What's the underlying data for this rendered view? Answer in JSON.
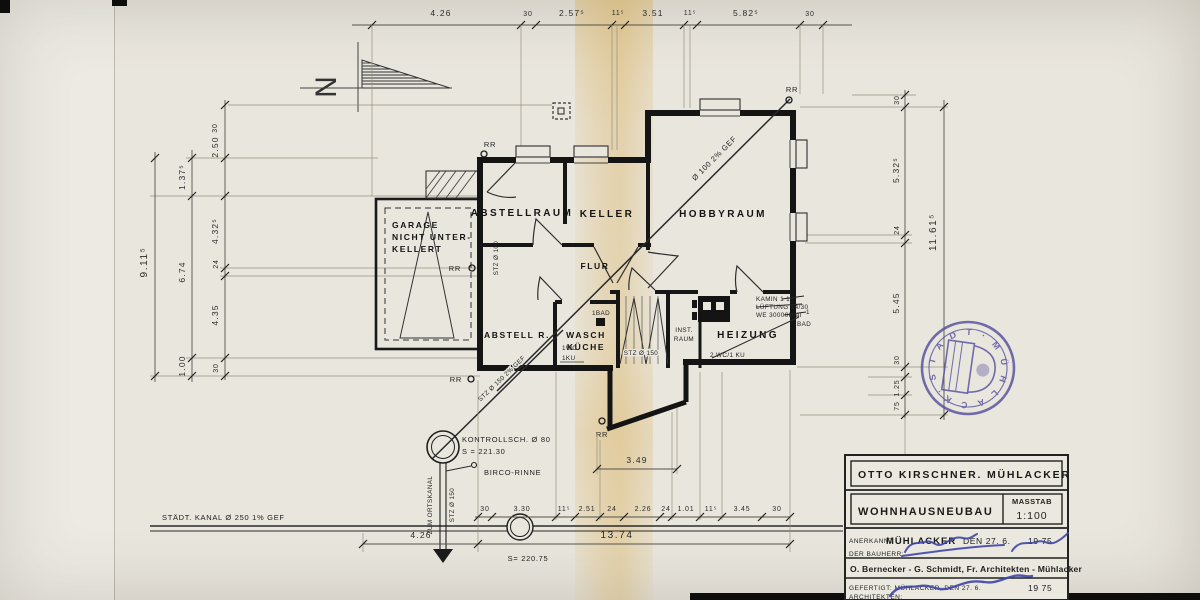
{
  "north": {
    "label": "N"
  },
  "dims": {
    "top": [
      "4.26",
      "30",
      "2.57⁵",
      "11⁵",
      "3.51",
      "11⁵",
      "5.82⁵",
      "30"
    ],
    "left_outer": "9.11⁵",
    "left_middle": [
      "1.37⁵",
      "6.74",
      "1.00"
    ],
    "left_inner": [
      "30",
      "2.50",
      "4.32⁵",
      "24",
      "4.35",
      "30"
    ],
    "right_outer": "11.61⁵",
    "right_inner": [
      "30",
      "5.32⁵",
      "24",
      "5.45",
      "30",
      "1.25",
      "75"
    ],
    "bottom_detail": [
      "30",
      "3.30",
      "11⁵",
      "2.51",
      "24",
      "2.26",
      "24",
      "1.01",
      "11⁵",
      "3.45",
      "30"
    ],
    "bottom_total": "13.74",
    "bottom_left_seg": "4.26",
    "exit_width": "3.49"
  },
  "rooms": {
    "garage_l1": "GARAGE",
    "garage_l2": "NICHT UNTER-",
    "garage_l3": "KELLERT",
    "abstellraum": "ABSTELLRAUM",
    "keller": "KELLER",
    "hobbyraum": "HOBBYRAUM",
    "flur": "FLUR",
    "abstell_r": "ABSTELL R.",
    "wasch_l1": "WASCH",
    "wasch_l2": "KÜCHE",
    "inst_l1": "INST.",
    "inst_l2": "RAUM",
    "heizung": "HEIZUNG"
  },
  "plumbing": {
    "pipe_main": "Ø 100 2% GEF",
    "pipe_stz": "STZ Ø 150 2% GEF",
    "stz100": "STZ Ø 100",
    "stz150_stairs": "STZ Ø 150",
    "rr": "RR",
    "kanal": "STÄDT. KANAL  Ø 250   1% GEF",
    "kontroll_l1": "KONTROLLSCH. Ø 80",
    "kontroll_l2": "S = 221.30",
    "birco": "BIRCO-RINNE",
    "zum_ortskanal": "ZUM ORTSKANAL",
    "stz150_vert": "STZ Ø 150",
    "s_level": "S= 220.75"
  },
  "annotations": {
    "kamin": "KAMIN 1 18⁵",
    "lueftung": "LÜFTUNG 14/30",
    "we": "WE  30000kcal",
    "bad1": "1BAD",
    "wc1": "1WC",
    "ku1": "1KU",
    "wc2": "2 WC/1 KU",
    "bad_right_num": "1",
    "bad_right": "BAD"
  },
  "title_block": {
    "owner": "OTTO KIRSCHNER. MÜHLACKER",
    "project": "WOHNHAUSNEUBAU",
    "masstab_label": "MASSTAB",
    "masstab_value": "1:100",
    "anerkannt_label": "ANERKANNT",
    "anerkannt_city": "MÜHLACKER",
    "anerkannt_den": "DEN 27. 6.",
    "anerkannt_year": "19 75",
    "bauherr_label": "DER BAUHERR:",
    "architects": "O. Bernecker - G. Schmidt, Fr. Architekten - Mühlacker",
    "gefertigt": "GEFERTIGT: MÜHLACKER, DEN 27. 6.",
    "gefertigt_year": "19 75",
    "architekten_label": "ARCHITEKTEN:"
  },
  "stamp": {
    "text": "· S T A D T ·  M Ü H L A C K E R"
  },
  "colors": {
    "ink": "#1c1c1c",
    "stamp": "#564f9e",
    "signature": "#3f46a8",
    "paper": "#e9e6de",
    "fold": "#d6a53e"
  }
}
